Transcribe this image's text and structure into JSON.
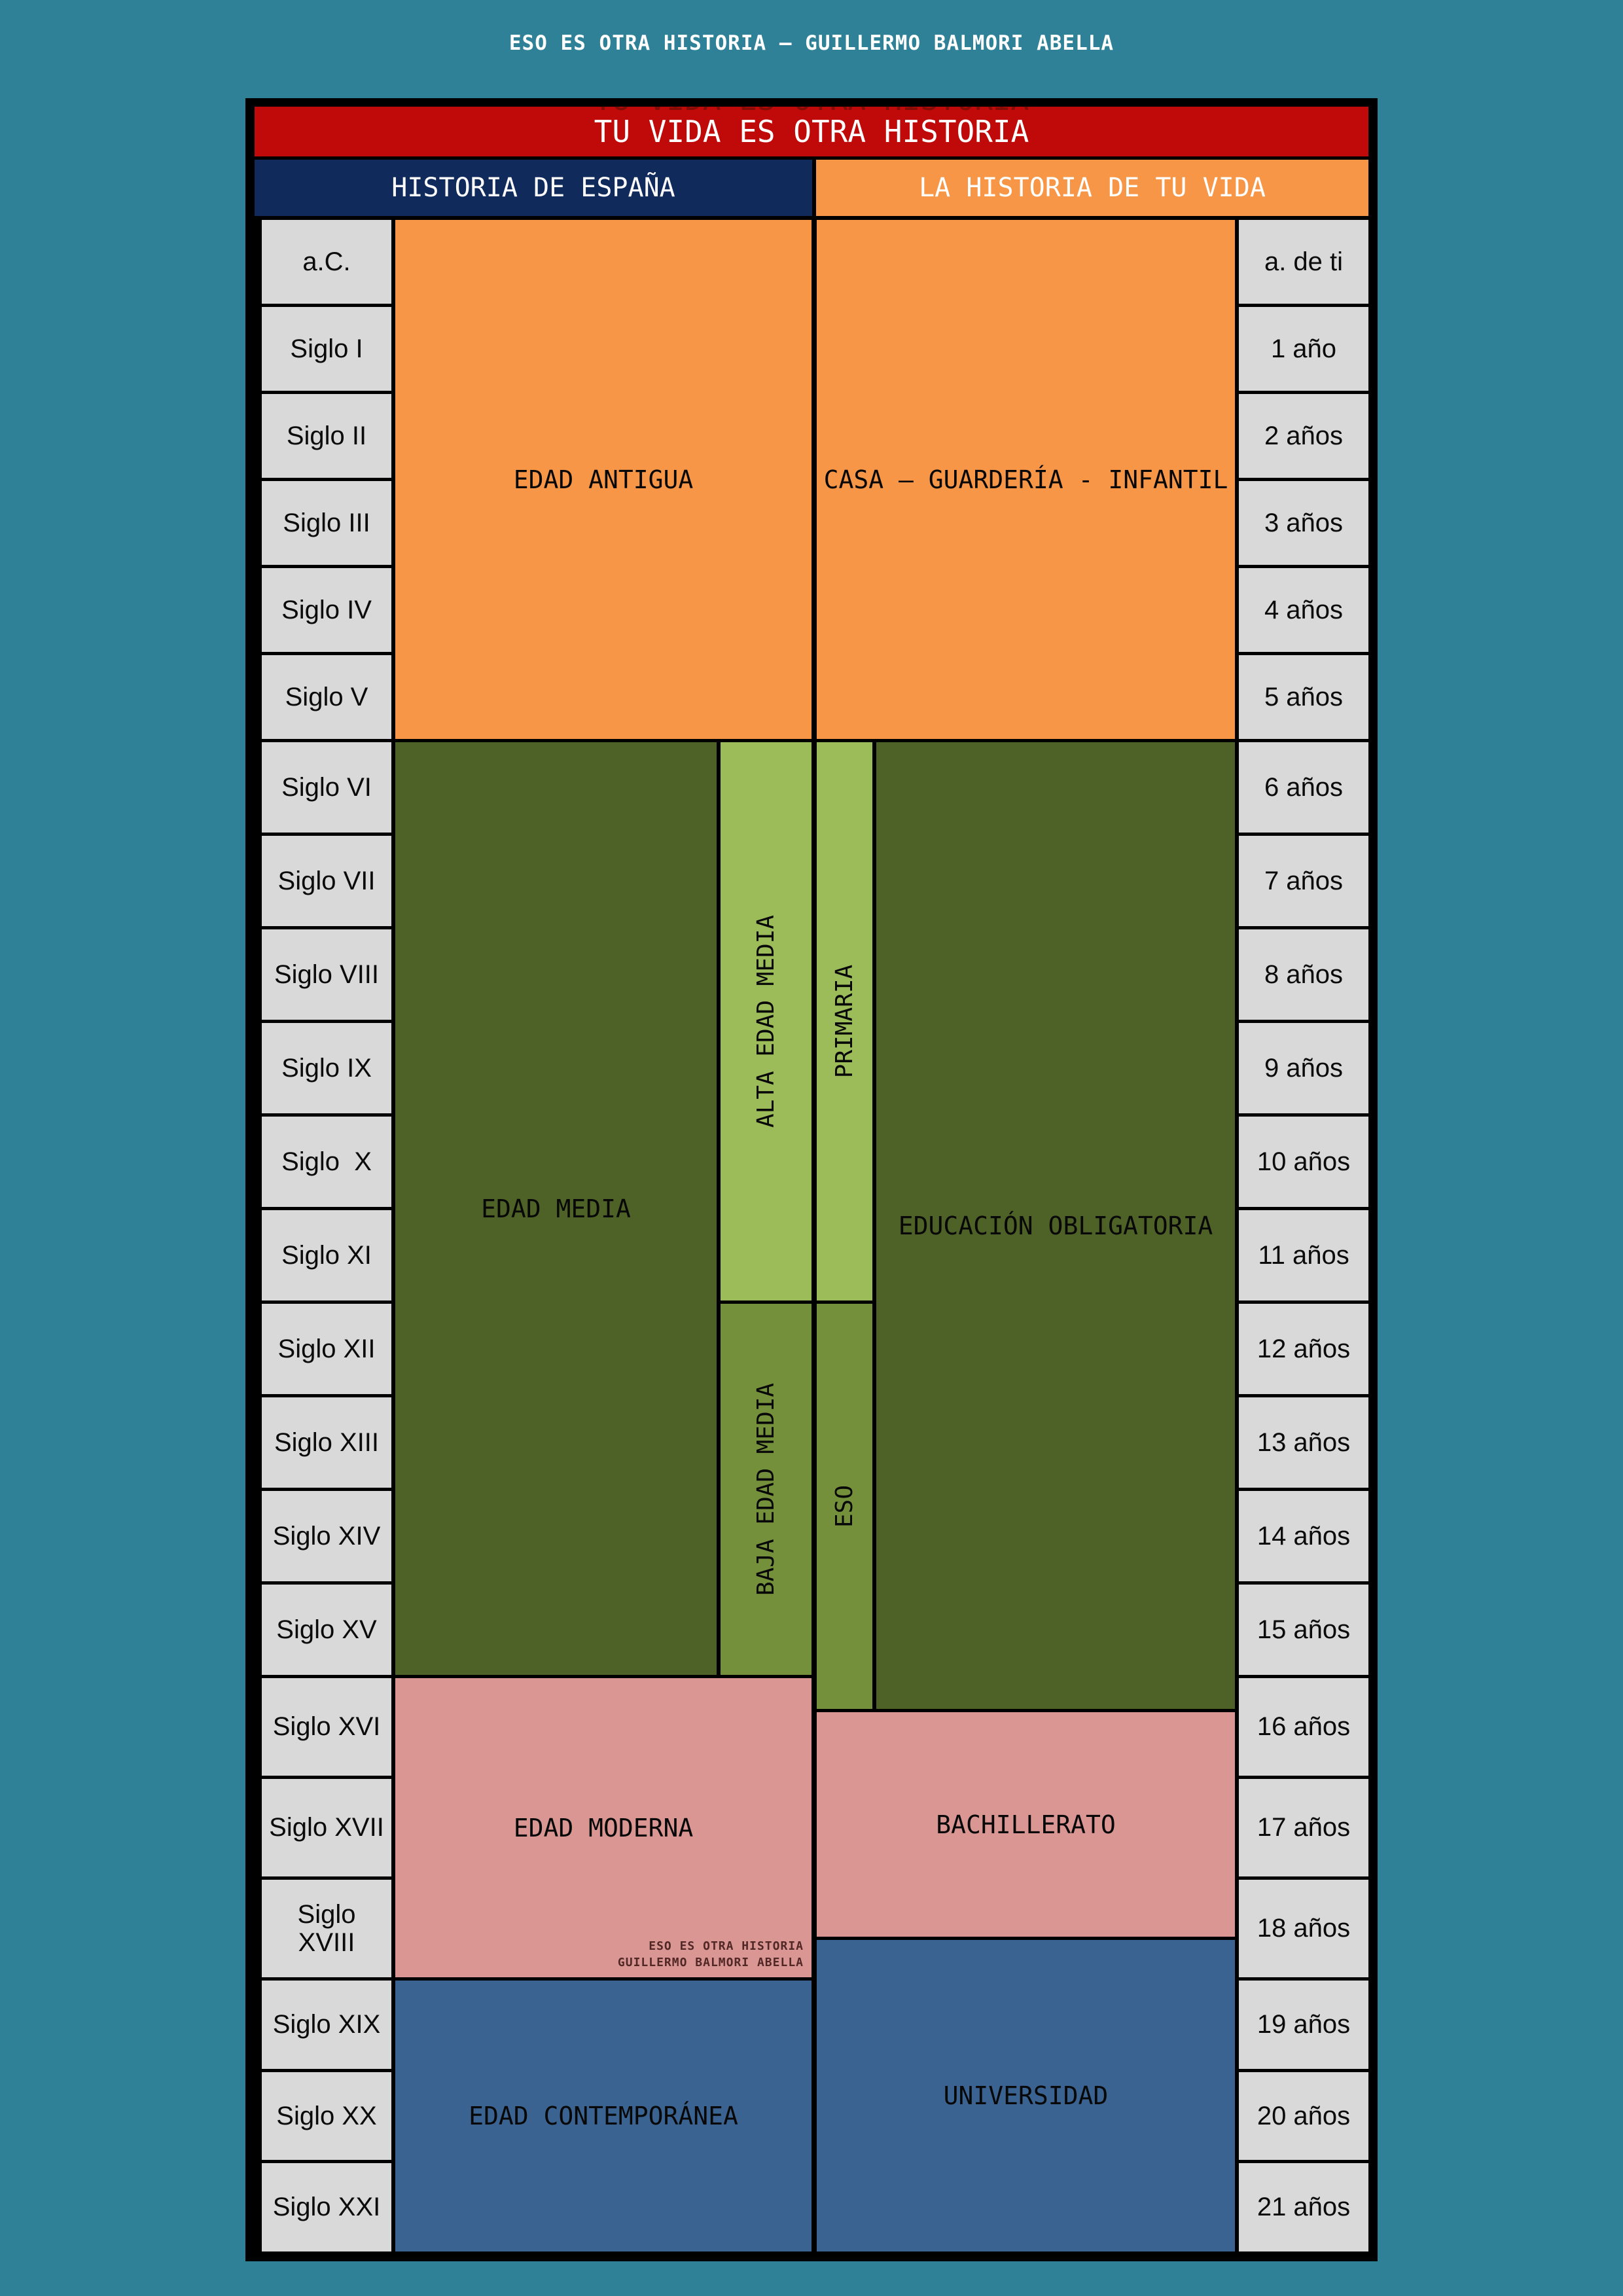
{
  "page_title": "ESO ES OTRA HISTORIA – GUILLERMO BALMORI ABELLA",
  "banner": {
    "title": "TU VIDA ES OTRA HISTORIA"
  },
  "headers": {
    "spain": "HISTORIA DE ESPAÑA",
    "life": "LA HISTORIA DE TU VIDA"
  },
  "centuries": [
    "a.C.",
    "Siglo I",
    "Siglo II",
    "Siglo III",
    "Siglo IV",
    "Siglo V",
    "Siglo VI",
    "Siglo VII",
    "Siglo VIII",
    "Siglo IX",
    "Siglo  X",
    "Siglo XI",
    "Siglo XII",
    "Siglo XIII",
    "Siglo XIV",
    "Siglo XV",
    "Siglo XVI",
    "Siglo XVII",
    "Siglo XVIII",
    "Siglo XIX",
    "Siglo XX",
    "Siglo XXI"
  ],
  "ages": [
    "a. de ti",
    "1 año",
    "2 años",
    "3 años",
    "4 años",
    "5 años",
    "6 años",
    "7 años",
    "8 años",
    "9 años",
    "10 años",
    "11 años",
    "12 años",
    "13 años",
    "14 años",
    "15 años",
    "16 años",
    "17 años",
    "18 años",
    "19 años",
    "20 años",
    "21 años"
  ],
  "periods": {
    "edad_antigua": {
      "label": "EDAD ANTIGUA",
      "side": "spain",
      "from": "a.C.",
      "to": "Siglo V"
    },
    "edad_media": {
      "label": "EDAD MEDIA",
      "side": "spain",
      "from": "Siglo VI",
      "to": "Siglo XV"
    },
    "alta_edad_media": {
      "label": "ALTA EDAD MEDIA",
      "side": "spain",
      "from": "Siglo VI",
      "to": "Siglo XI"
    },
    "baja_edad_media": {
      "label": "BAJA EDAD MEDIA",
      "side": "spain",
      "from": "Siglo XII",
      "to": "Siglo XV"
    },
    "edad_moderna": {
      "label": "EDAD MODERNA",
      "side": "spain",
      "from": "Siglo XVI",
      "to": "Siglo XVIII"
    },
    "edad_contemporanea": {
      "label": "EDAD CONTEMPORÁNEA",
      "side": "spain",
      "from": "Siglo XIX",
      "to": "Siglo XXI"
    },
    "casa": {
      "label": "CASA – GUARDERÍA - INFANTIL",
      "side": "life",
      "from": "a. de ti",
      "to": "5 años"
    },
    "educacion_obligatoria": {
      "label": "EDUCACIÓN OBLIGATORIA",
      "side": "life",
      "from": "6 años",
      "to": "16 años"
    },
    "primaria": {
      "label": "PRIMARIA",
      "side": "life",
      "from": "6 años",
      "to": "11 años"
    },
    "eso": {
      "label": "ESO",
      "side": "life",
      "from": "12 años",
      "to": "16 años"
    },
    "bachillerato": {
      "label": "BACHILLERATO",
      "side": "life",
      "from": "16 años",
      "to": "18 años"
    },
    "universidad": {
      "label": "UNIVERSIDAD",
      "side": "life",
      "from": "18 años",
      "to": "21 años"
    }
  },
  "watermark": {
    "line1": "ESO ES OTRA HISTORIA",
    "line2": "GUILLERMO BALMORI ABELLA"
  },
  "colors": {
    "page_background": "#2e8196",
    "banner_red": "#c00909",
    "header_navy": "#102a5c",
    "orange": "#f79646",
    "dark_olive": "#4e6227",
    "light_green": "#9bbc59",
    "medium_green": "#74903b",
    "pink": "#d99693",
    "blue": "#3a6391",
    "cell_gray": "#d9d9d9",
    "grid_black": "#000000"
  }
}
